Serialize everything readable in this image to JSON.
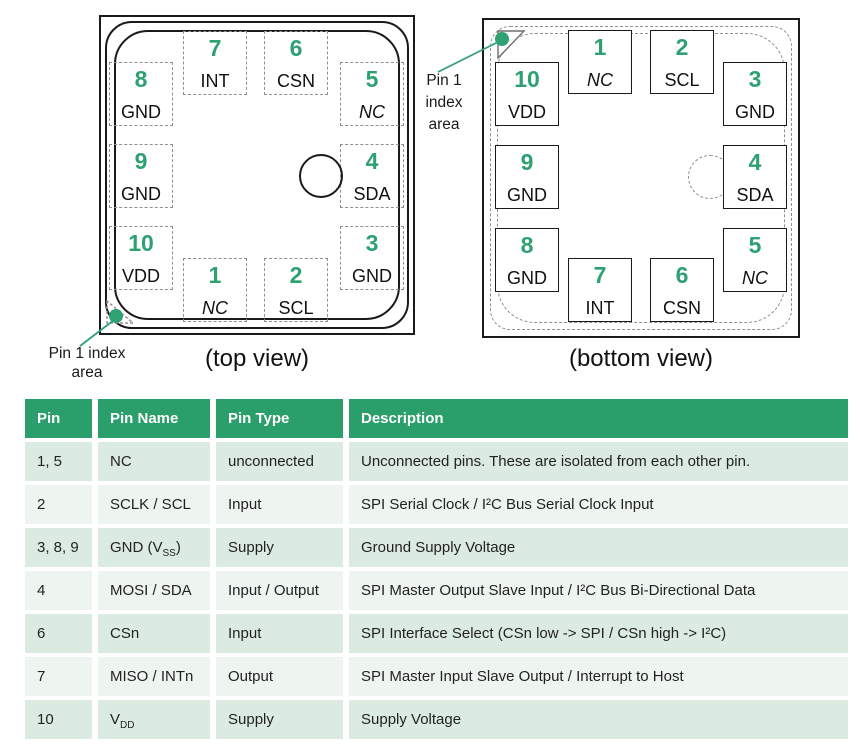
{
  "colors": {
    "accent_green": "#2fa173",
    "header_green": "#2a9e6b",
    "row_dark": "#dcebe2",
    "row_light": "#eef5f0"
  },
  "top_view": {
    "caption": "(top view)",
    "index_label": {
      "line1": "Pin 1 index",
      "line2": "area"
    },
    "pads": [
      {
        "number": "7",
        "name": "INT"
      },
      {
        "number": "6",
        "name": "CSN"
      },
      {
        "number": "8",
        "name": "GND"
      },
      {
        "number": "9",
        "name": "GND"
      },
      {
        "number": "10",
        "name": "VDD"
      },
      {
        "number": "5",
        "name": "NC"
      },
      {
        "number": "4",
        "name": "SDA"
      },
      {
        "number": "3",
        "name": "GND"
      },
      {
        "number": "1",
        "name": "NC"
      },
      {
        "number": "2",
        "name": "SCL"
      }
    ]
  },
  "bottom_view": {
    "caption": "(bottom view)",
    "index_label": {
      "line1": "Pin 1",
      "line2": "index",
      "line3": "area"
    },
    "pads": [
      {
        "number": "1",
        "name": "NC"
      },
      {
        "number": "2",
        "name": "SCL"
      },
      {
        "number": "10",
        "name": "VDD"
      },
      {
        "number": "9",
        "name": "GND"
      },
      {
        "number": "8",
        "name": "GND"
      },
      {
        "number": "3",
        "name": "GND"
      },
      {
        "number": "4",
        "name": "SDA"
      },
      {
        "number": "5",
        "name": "NC"
      },
      {
        "number": "7",
        "name": "INT"
      },
      {
        "number": "6",
        "name": "CSN"
      }
    ]
  },
  "table": {
    "headers": [
      "Pin",
      "Pin Name",
      "Pin Type",
      "Description"
    ],
    "rows": [
      {
        "pin": "1, 5",
        "name_pre": "NC",
        "name_sub": "",
        "name_post": "",
        "type": "unconnected",
        "desc": "Unconnected pins. These are isolated from each other pin."
      },
      {
        "pin": "2",
        "name_pre": "SCLK / SCL",
        "name_sub": "",
        "name_post": "",
        "type": "Input",
        "desc": "SPI Serial Clock / I²C Bus Serial Clock Input"
      },
      {
        "pin": "3, 8, 9",
        "name_pre": "GND (V",
        "name_sub": "SS",
        "name_post": ")",
        "type": "Supply",
        "desc": "Ground Supply Voltage"
      },
      {
        "pin": "4",
        "name_pre": "MOSI / SDA",
        "name_sub": "",
        "name_post": "",
        "type": "Input / Output",
        "desc": "SPI Master Output Slave Input / I²C Bus Bi-Directional Data"
      },
      {
        "pin": "6",
        "name_pre": "CSn",
        "name_sub": "",
        "name_post": "",
        "type": "Input",
        "desc": "SPI Interface Select (CSn low -> SPI / CSn high -> I²C)"
      },
      {
        "pin": "7",
        "name_pre": "MISO / INTn",
        "name_sub": "",
        "name_post": "",
        "type": "Output",
        "desc": "SPI Master Input Slave Output / Interrupt to Host"
      },
      {
        "pin": "10",
        "name_pre": "V",
        "name_sub": "DD",
        "name_post": "",
        "type": "Supply",
        "desc": "Supply Voltage"
      }
    ]
  }
}
